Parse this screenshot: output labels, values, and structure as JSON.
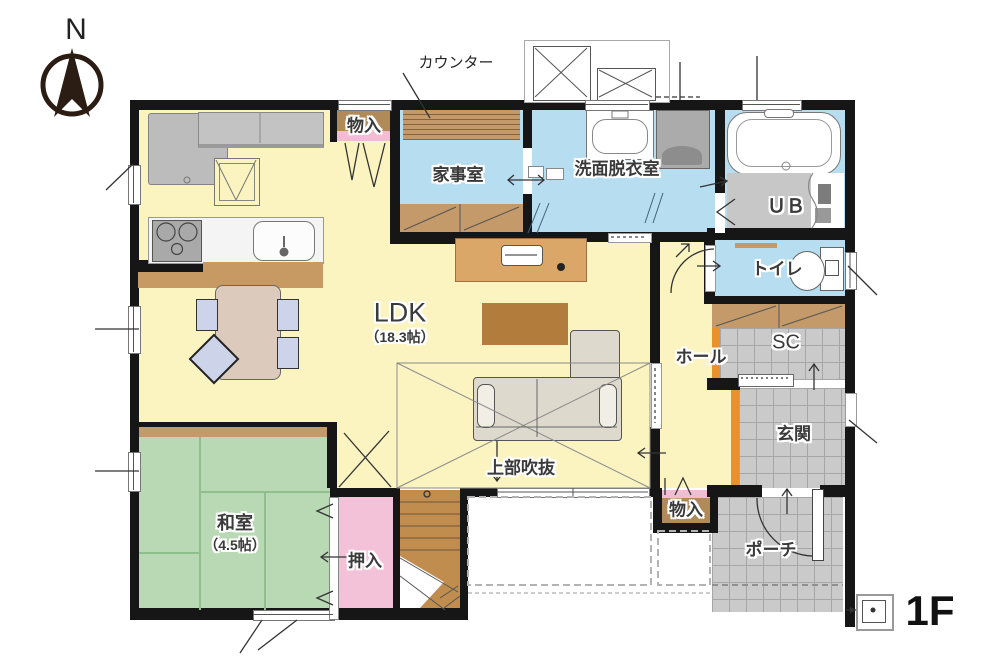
{
  "title": "1F floor plan",
  "labels": {
    "compass_n": "N",
    "counter": "カウンター",
    "storage_top": "物入",
    "utility_room": "家事室",
    "washroom": "洗面脱衣室",
    "unit_bath": "ＵＢ",
    "toilet": "トイレ",
    "hall": "ホール",
    "shoe_closet": "SC",
    "entrance": "玄関",
    "storage_bottom": "物入",
    "porch": "ポーチ",
    "ldk_name": "LDK",
    "ldk_size": "（18.3帖）",
    "void_above": "上部吹抜",
    "japanese_room_name": "和室",
    "japanese_room_size": "（4.5帖）",
    "closet": "押入",
    "floor": "1F"
  },
  "colors": {
    "floor_yellow": "#fbf4c1",
    "water_blue": "#b7ddf1",
    "tatami_green": "#b9d8b4",
    "closet_pink": "#f4c2d8",
    "wood_brown": "#c49a6a",
    "stair_brown": "#c08d4f",
    "tile_gray": "#cacaca",
    "step_orange": "#e8912d",
    "wall_black": "#161616"
  }
}
